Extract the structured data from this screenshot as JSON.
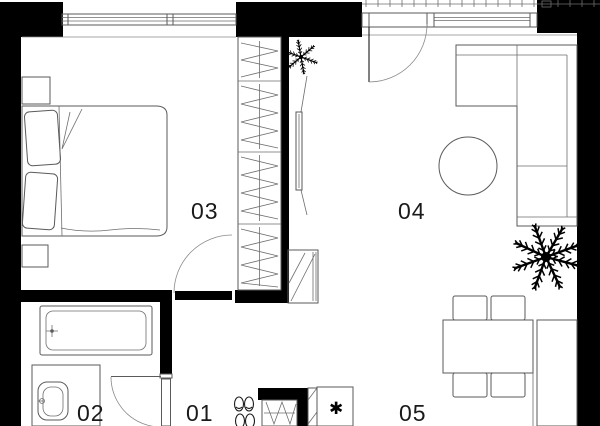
{
  "title": "apartment-floor-plan",
  "colors": {
    "wall": "#000000",
    "furniture_line": "#5a5a5a",
    "thin_line": "#8a8a8a",
    "label_text": "#1a1a1a",
    "background": "#ffffff"
  },
  "rooms": [
    {
      "id": "room-01",
      "label": "01",
      "name": "hallway"
    },
    {
      "id": "room-02",
      "label": "02",
      "name": "bathroom"
    },
    {
      "id": "room-03",
      "label": "03",
      "name": "bedroom"
    },
    {
      "id": "room-04",
      "label": "04",
      "name": "living-room"
    },
    {
      "id": "room-05",
      "label": "05",
      "name": "kitchen-dining"
    }
  ],
  "symbols": {
    "appliance_star": "✱"
  },
  "icons": [
    "double-bed",
    "pillow",
    "nightstand",
    "wardrobe",
    "tv",
    "tv-stand",
    "sofa",
    "coffee-table",
    "plant-large",
    "plant-small",
    "dining-table",
    "dining-chair",
    "kitchen-counter",
    "fridge-freezer",
    "tall-cabinet",
    "hall-closet",
    "shoes",
    "bathtub",
    "washbasin",
    "vanity-counter",
    "door-arc",
    "window",
    "balcony-railing"
  ]
}
